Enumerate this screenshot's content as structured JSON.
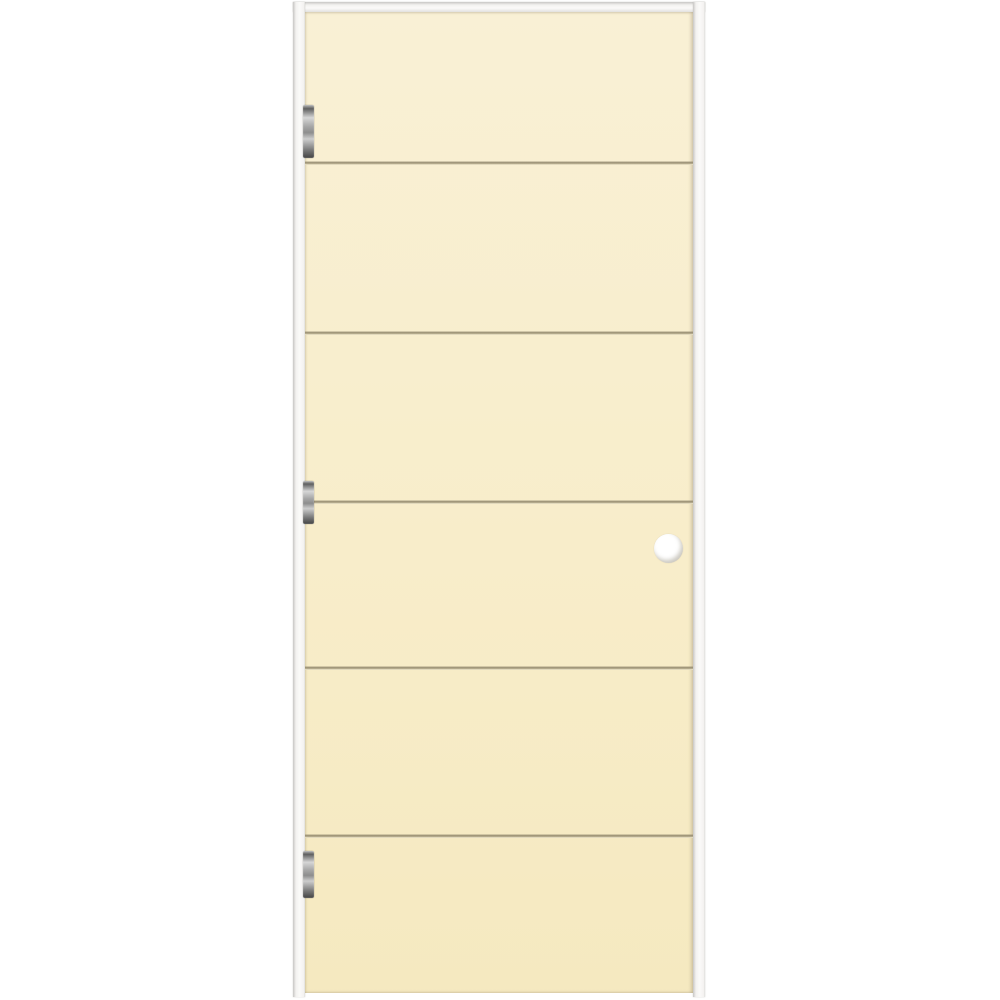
{
  "meta": {
    "type": "product-photo",
    "subject": "prehung-flush-interior-door-with-horizontal-grooves",
    "visible_text": ""
  },
  "colors": {
    "background": "#ffffff",
    "door-top": "#f9f0d5",
    "door-mid": "#f8edca",
    "door-bottom": "#f5e9c0",
    "groove-dark": "#958b70",
    "groove-light": "#fbf3d9",
    "frame-face": "#f3f2f0",
    "frame-edge": "#c8c7c5",
    "hinge-dark": "#5f5f5f",
    "hinge-light": "#d6d6d6",
    "bore-fill": "#ffffff"
  },
  "frame": {
    "head": {
      "x": 293,
      "y": 2,
      "width": 412,
      "height": 10
    },
    "left_jamb": {
      "x": 293,
      "y": 2,
      "width": 12,
      "height": 995
    },
    "right_jamb": {
      "x": 693,
      "y": 2,
      "width": 12,
      "height": 995
    }
  },
  "door": {
    "slab": {
      "x": 305,
      "y": 12,
      "width": 388,
      "height": 981
    },
    "panel_count": 6,
    "grooves_y": [
      163,
      333,
      502,
      668,
      836
    ],
    "bore_hole": {
      "cx": 668,
      "cy": 548,
      "r": 14.5
    }
  },
  "hinges": {
    "x": 303,
    "width": 11,
    "items": [
      {
        "position": "top",
        "y": 105,
        "height": 53
      },
      {
        "position": "middle",
        "y": 481,
        "height": 43
      },
      {
        "position": "bottom",
        "y": 851,
        "height": 47
      }
    ]
  }
}
